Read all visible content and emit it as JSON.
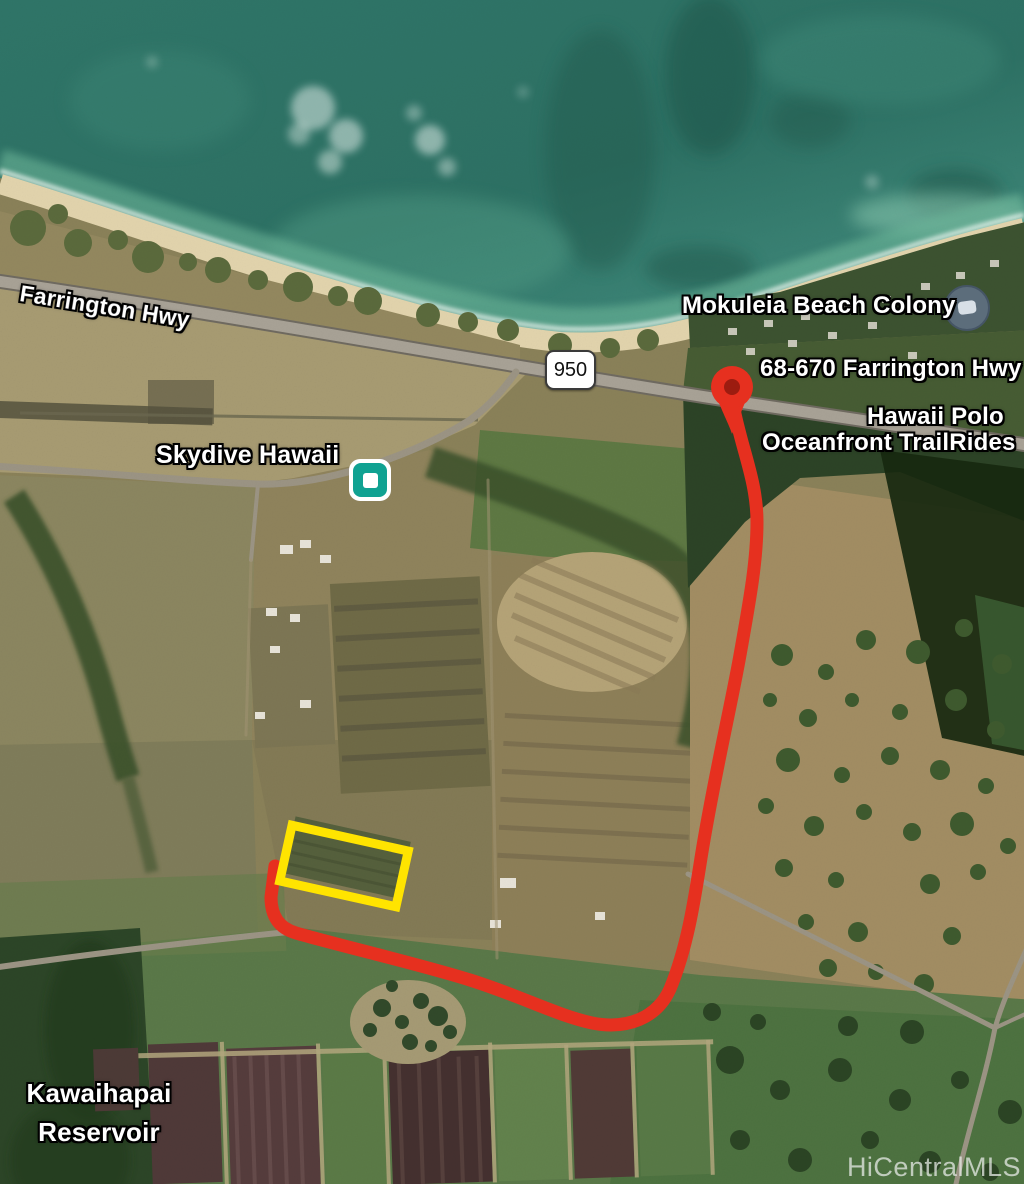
{
  "map": {
    "type": "satellite-map-image",
    "labels": {
      "highway": "Farrington Hwy",
      "route_shield": "950",
      "beach_colony": "Mokuleia Beach Colony",
      "address": "68-670 Farrington Hwy",
      "polo_line1": "Hawaii Polo",
      "polo_line2": "Oceanfront TrailRides",
      "skydive": "Skydive Hawaii",
      "reservoir_line1": "Kawaihapai",
      "reservoir_line2": "Reservoir"
    },
    "watermark": "HiCentralMLS",
    "markers": {
      "destination_pin": {
        "label": "68-670 Farrington Hwy",
        "color": "#e6301f",
        "inner_color": "#9c1c10"
      },
      "skydive_poi": {
        "label": "Skydive Hawaii",
        "color": "#10a292"
      },
      "lodging_poi": {
        "label": "Mokuleia Beach Colony",
        "color": "#5f6f82"
      }
    },
    "overlays": {
      "route_color": "#e6301f",
      "property_boundary_color": "#ffe400",
      "shield_background": "#ffffff"
    }
  }
}
